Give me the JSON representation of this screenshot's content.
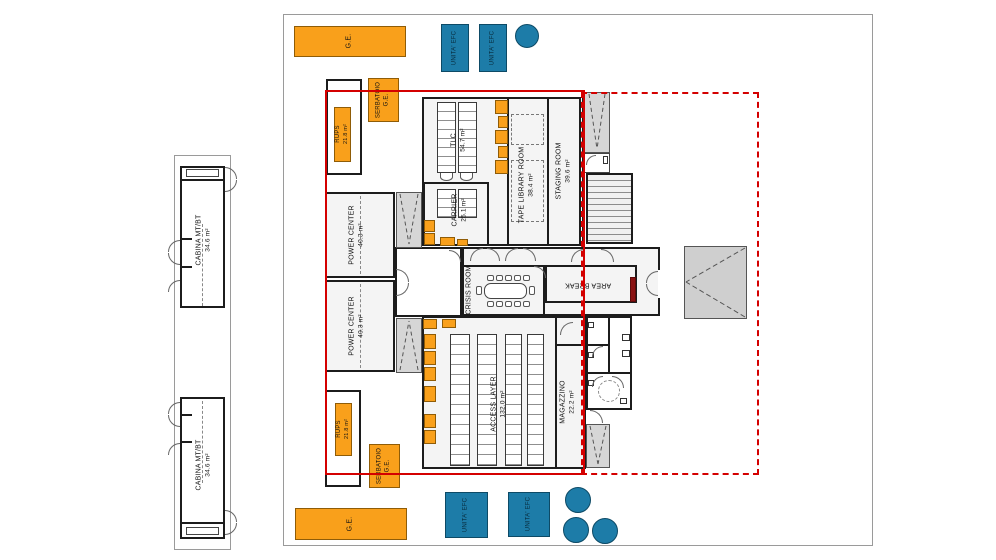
{
  "plan": {
    "title": "Data center floor plan",
    "rooms": {
      "cabina": {
        "name": "CABINA MT/BT",
        "area": "34.6 m²"
      },
      "tlc": {
        "name": "TLC",
        "area": "54.7 m²"
      },
      "carrier": {
        "name": "CARRIER",
        "area": "25.1 m²"
      },
      "tape_library": {
        "name": "TAPE LIBRARY ROOM",
        "area": "38.4 m²"
      },
      "staging": {
        "name": "STAGING ROOM",
        "area": "39.6 m²"
      },
      "power_center": {
        "name": "POWER CENTER",
        "area": "40.3 m²"
      },
      "crisis": {
        "name": "CRISIS ROOM"
      },
      "area_break": {
        "name": "AREA BREAK"
      },
      "access_layer": {
        "name": "ACCESS LAYER",
        "area": "132.0 m²"
      },
      "magazzino": {
        "name": "MAGAZZINO",
        "area": "22.2 m²"
      }
    },
    "equipment": {
      "ge": {
        "name": "G.E."
      },
      "unita_efc": {
        "name": "UNITA' EFC"
      },
      "rups": {
        "name": "RUPS",
        "area": "21.8 m²"
      },
      "serbatoio": {
        "line1": "SERBATOIO",
        "line2": "G.E."
      }
    },
    "colors": {
      "equipment_orange": "#F9A01B",
      "equipment_teal": "#1D7CA8",
      "boundary_red": "#D40000"
    }
  }
}
